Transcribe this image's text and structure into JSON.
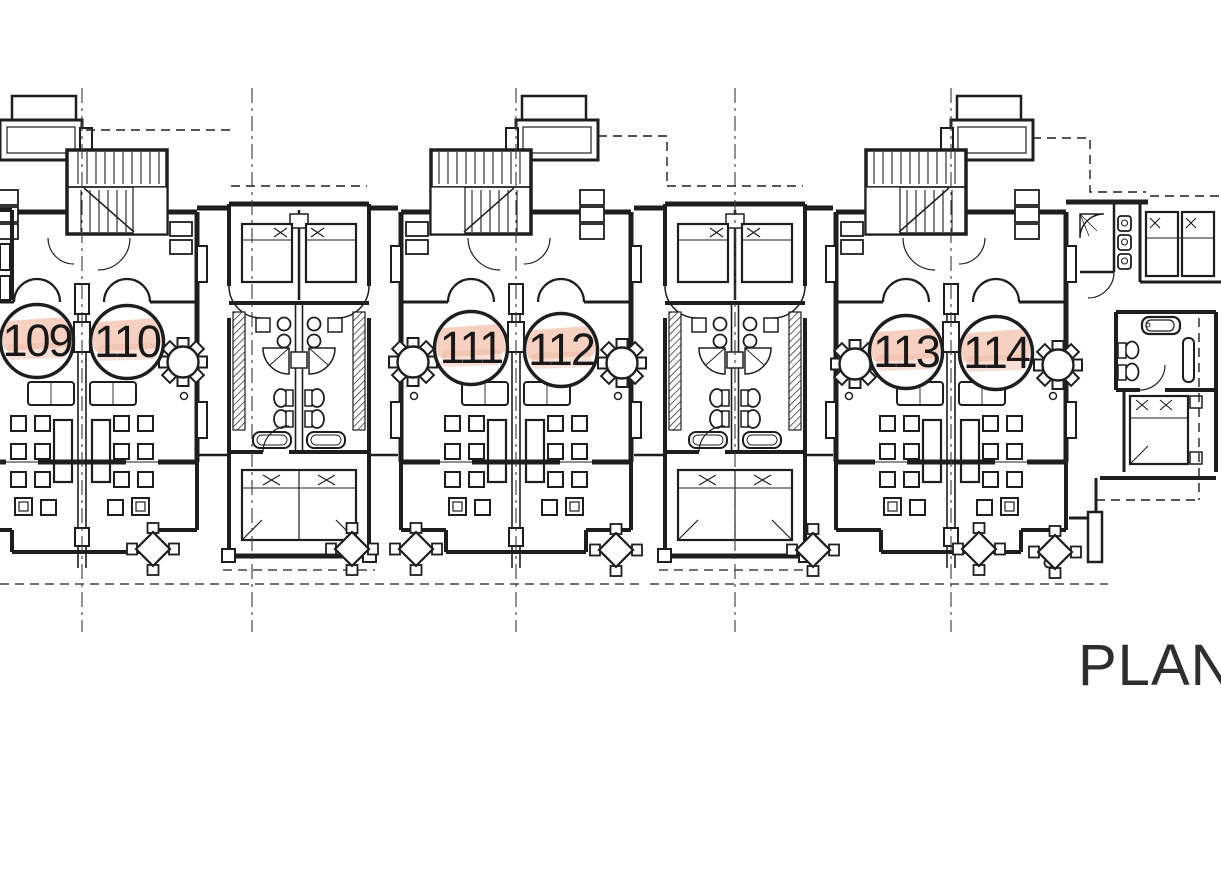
{
  "page": {
    "background": "#ffffff"
  },
  "plan": {
    "caption": "PLAN",
    "units": [
      {
        "number": "109"
      },
      {
        "number": "110"
      },
      {
        "number": "111"
      },
      {
        "number": "112"
      },
      {
        "number": "113"
      },
      {
        "number": "114"
      }
    ],
    "colors": {
      "ink": "#1e1e1e",
      "highlight": "#f4c9b6",
      "paper": "#ffffff"
    }
  }
}
